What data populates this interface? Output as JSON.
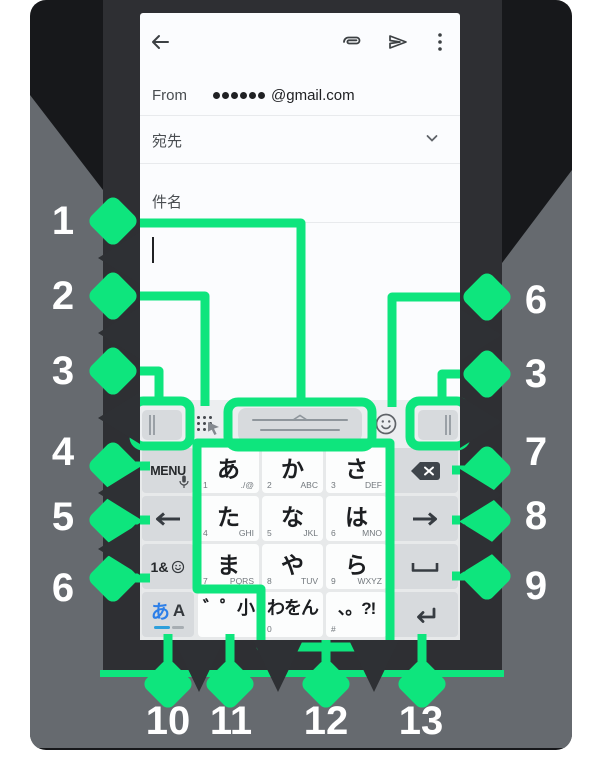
{
  "colors": {
    "callout_green": "#0ee57d",
    "band_gray": "#666a6f",
    "backdrop_black": "#17181b",
    "phone_frame_charcoal": "#2e2f33",
    "mode_active_blue": "#2d7fe8"
  },
  "appbar": {
    "icons": [
      "back-arrow",
      "attach-paperclip",
      "send",
      "overflow-menu"
    ]
  },
  "compose": {
    "from_label": "From",
    "masked_email_domain": "@gmail.com",
    "masked_dot_count": 6,
    "to_label": "宛先",
    "subject_label": "件名"
  },
  "toolbar": {
    "icons": [
      "left-edge-handle",
      "cursor-grip-hand",
      "candidate-handle-bar",
      "emoji-smiley",
      "right-edge-handle"
    ]
  },
  "keyboard": {
    "menu_key": {
      "label": "MENU",
      "icon": "mic"
    },
    "num_emoji_key": {
      "label": "1&",
      "icon": "smiley"
    },
    "mode_key": {
      "kana": "あ",
      "latin": "A"
    },
    "grid": [
      [
        {
          "main": "あ",
          "sub_l": "1",
          "sub_r": "./@"
        },
        {
          "main": "か",
          "sub_l": "2",
          "sub_r": "ABC"
        },
        {
          "main": "さ",
          "sub_l": "3",
          "sub_r": "DEF"
        }
      ],
      [
        {
          "main": "た",
          "sub_l": "4",
          "sub_r": "GHI"
        },
        {
          "main": "な",
          "sub_l": "5",
          "sub_r": "JKL"
        },
        {
          "main": "は",
          "sub_l": "6",
          "sub_r": "MNO"
        }
      ],
      [
        {
          "main": "ま",
          "sub_l": "7",
          "sub_r": "PQRS"
        },
        {
          "main": "や",
          "sub_l": "8",
          "sub_r": "TUV"
        },
        {
          "main": "ら",
          "sub_l": "9",
          "sub_r": "WXYZ"
        }
      ],
      [
        {
          "main": "゛゜小"
        },
        {
          "main": "わをん",
          "sub_l": "0"
        },
        {
          "main": "、。?!",
          "sub_l": "#"
        }
      ]
    ],
    "func_right_icons": [
      "backspace",
      "arrow-right",
      "space",
      "enter"
    ]
  },
  "callouts": {
    "left": [
      "1",
      "2",
      "3",
      "4",
      "5",
      "6"
    ],
    "right": [
      "6",
      "3",
      "7",
      "8",
      "9"
    ],
    "bottom": [
      "10",
      "11",
      "12",
      "13"
    ]
  }
}
